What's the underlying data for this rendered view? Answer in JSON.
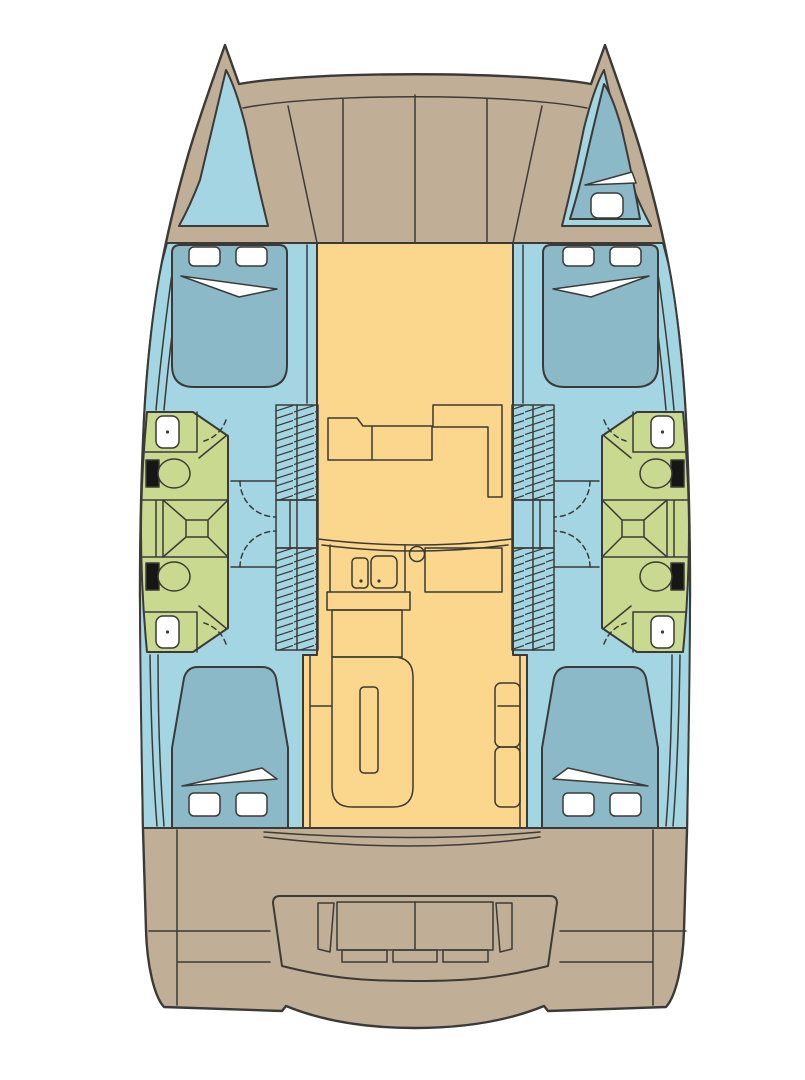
{
  "meta": {
    "title": "Catamaran interior layout plan",
    "view": "Top-down deck and accommodation floor plan",
    "orientation": "Bows at top, stern at bottom",
    "visible_text": ""
  },
  "palette": {
    "background": "#ffffff",
    "outline": "#3b3a37",
    "deck": "#c1ae97",
    "hull": "#a3d5e2",
    "berth": "#8cb9c7",
    "bathroom": "#c9d98f",
    "salon": "#fbd78d",
    "white": "#ffffff",
    "black": "#161616"
  },
  "areas": {
    "foredeck": {
      "name": "foredeck with crossbeam and deck panels",
      "panels": 4
    },
    "port_bow": {
      "name": "port bow locker"
    },
    "starboard_bow": {
      "name": "starboard bow berth",
      "contents": [
        "single berth",
        "blanket",
        "hatch pillow"
      ]
    },
    "cabins": [
      {
        "name": "port forward cabin",
        "berth": "double",
        "pillows": 2,
        "blanket": true
      },
      {
        "name": "starboard forward cabin",
        "berth": "double",
        "pillows": 2,
        "blanket": true
      },
      {
        "name": "port aft cabin",
        "berth": "double",
        "pillows": 2,
        "blanket": true
      },
      {
        "name": "starboard aft cabin",
        "berth": "double",
        "pillows": 2,
        "blanket": true
      }
    ],
    "bathrooms": [
      {
        "name": "port heads block",
        "fixtures": [
          "washbasin",
          "toilet",
          "central shower",
          "toilet",
          "washbasin"
        ],
        "doors": 2
      },
      {
        "name": "starboard heads block",
        "fixtures": [
          "washbasin",
          "toilet",
          "central shower",
          "toilet",
          "washbasin"
        ],
        "doors": 2
      }
    ],
    "salon": {
      "name": "salon and galley",
      "features": [
        "forward seat and desk",
        "L-shaped counter",
        "twin galley sinks",
        "round burner",
        "galley counters",
        "dinette settee with table",
        "two starboard seats"
      ]
    },
    "companionways": [
      {
        "name": "port companionway",
        "stair_flights": 2,
        "landing": true,
        "doors": 2
      },
      {
        "name": "starboard companionway",
        "stair_flights": 2,
        "landing": true,
        "doors": 2
      }
    ],
    "cockpit": {
      "name": "aft cockpit",
      "back_cushions": 2,
      "seat_cushions": 3,
      "armrests": 2
    },
    "stern": {
      "name": "transom steps and swim platform"
    }
  }
}
